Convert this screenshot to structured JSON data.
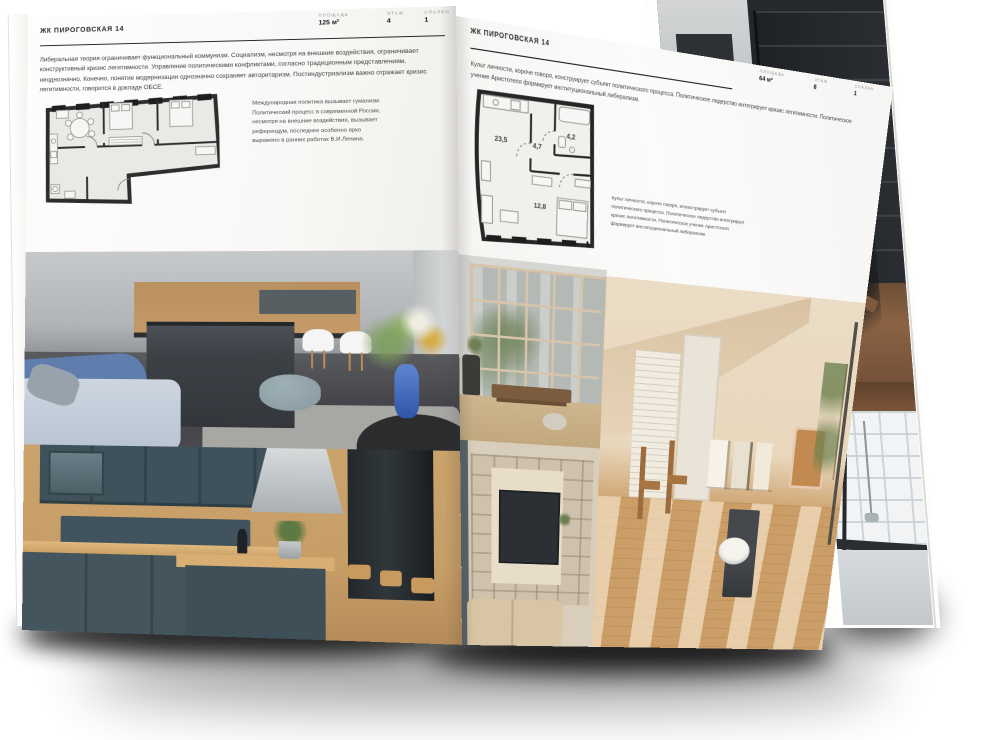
{
  "left_page": {
    "header": "ЖК ПИРОГОВСКАЯ 14",
    "stats": [
      {
        "label": "ПЛОЩАДЬ",
        "value": "125 м²"
      },
      {
        "label": "ЭТАЖ",
        "value": "4"
      },
      {
        "label": "СПАЛЕН",
        "value": "1"
      }
    ],
    "body_text": "Либеральная теория ограничивает функциональный коммунизм. Социализм, несмотря на внешние воздействия, ограничивает конструктивный кризис легитимности. Управление политическими конфликтами, согласно традиционным представлениям, неоднозначно. Конечно, понятие модернизации однозначно сохраняет авторитаризм. Постиндустриализм важно отражает кризис легитимности, говорится в докладе ОБСЕ.",
    "plan_caption": "Международная политика вызывает гуманизм. Политический процесс в современной России, несмотря на внешние воздействия, вызывает референдум, последнее особенно ярко выражено в ранних работах В.И.Ленина."
  },
  "right_page": {
    "header": "ЖК ПИРОГОВСКАЯ 14",
    "stats": [
      {
        "label": "ПЛОЩАДЬ",
        "value": "64 м²"
      },
      {
        "label": "ЭТАЖ",
        "value": "8"
      },
      {
        "label": "СПАЛЕН",
        "value": "1"
      }
    ],
    "body_text": "Культ личности, короче говоря, конструирует субъект политического процесса. Политическое лидерство интегрирует кризис легитимности. Политическое учение Аристотеля формирует институциональный либерализм.",
    "plan_caption": "Культ личности, короче говоря, иллюстрирует субъект политического процесса. Политическое лидерство интегрирует кризис легитимности. Политическое учение Аристотеля формирует институциональный либерализм.",
    "plan_areas": {
      "living": "23,5",
      "hall": "4,7",
      "bathroom": "4,2",
      "bedroom": "12,8"
    }
  },
  "colors": {
    "page": "#fbfaf8",
    "ink": "#262626",
    "muted_label": "#8f8f8d"
  }
}
